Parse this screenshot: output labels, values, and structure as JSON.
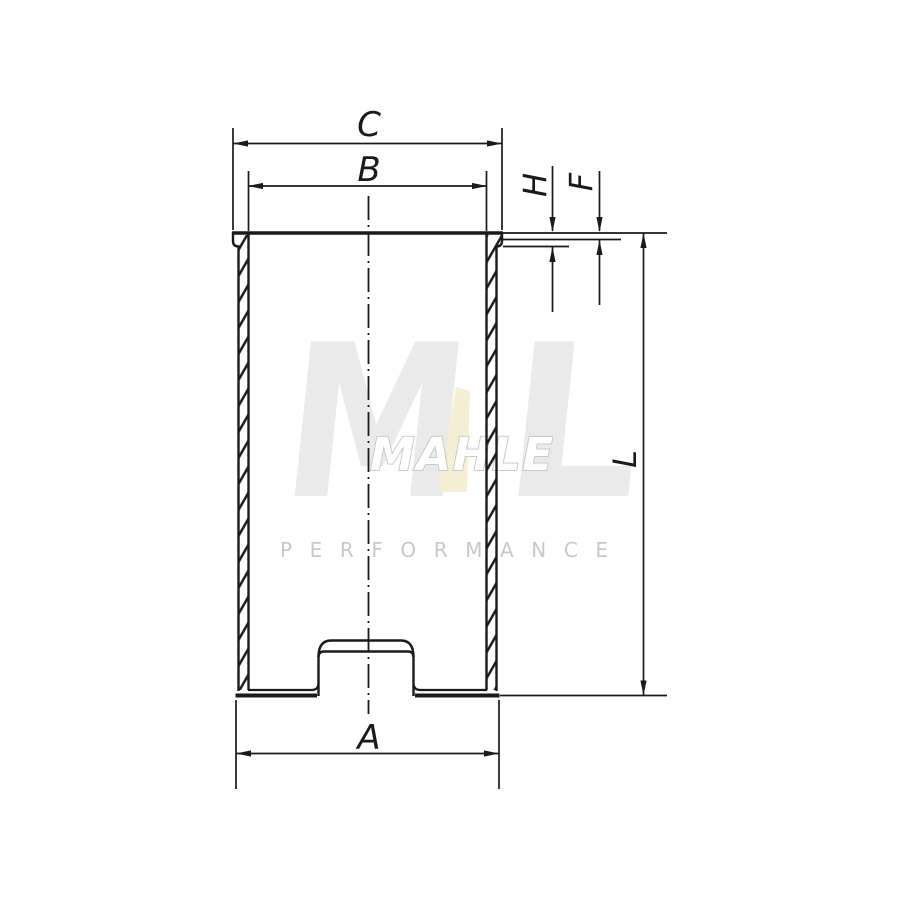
{
  "labels": {
    "c": "C",
    "b": "B",
    "a": "A",
    "h": "H",
    "f": "F",
    "l": "L"
  },
  "watermark": {
    "logo_left": "M",
    "logo_right": "L",
    "brand": "MAHLE",
    "tagline": "PERFORMANCE"
  },
  "colors": {
    "line": "#1a1a1a",
    "background": "#ffffff",
    "watermark_logo_gray": "#eaeaea",
    "watermark_brand_outline": "#c6c6c6",
    "watermark_tagline_gray": "#c8c8c8",
    "watermark_accent_cream": "#f6eed2"
  }
}
